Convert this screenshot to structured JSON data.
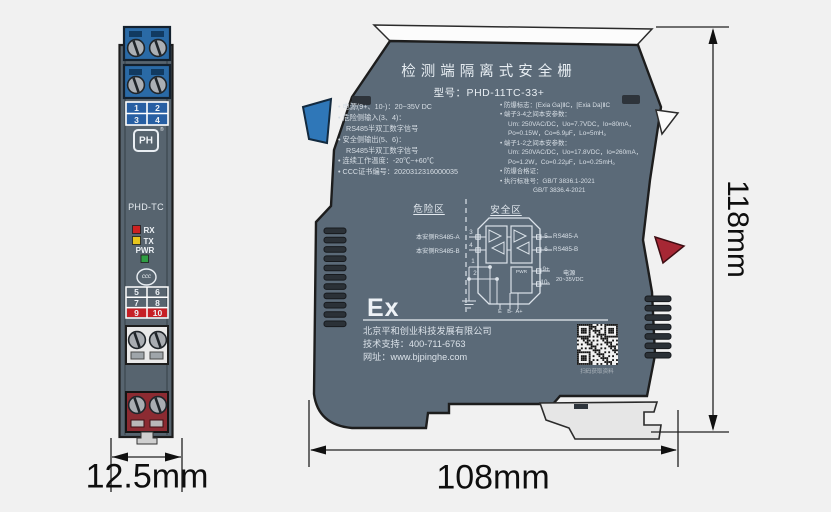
{
  "dimensions": {
    "front_width": "12.5mm",
    "side_width": "108mm",
    "side_height": "118mm"
  },
  "front_view": {
    "model": "PHD-TC",
    "logo": "PH",
    "logo_reg": "®",
    "led_rx": "RX",
    "led_tx": "TX",
    "led_pwr": "PWR",
    "cert_mark": "ccc",
    "terminals_top": [
      "1",
      "2",
      "3",
      "4"
    ],
    "terminals_bottom": [
      "5",
      "6",
      "7",
      "8",
      "9",
      "10"
    ]
  },
  "side_view": {
    "title": "检测端隔离式安全栅",
    "model": "型号：PHD-11TC-33+",
    "specs_left": [
      "• 电源(9+、10-)：20~35V DC",
      "• 危险侧输入(3、4)：",
      "RS485半双工数字信号",
      "• 安全侧输出(5、6)：",
      "RS485半双工数字信号",
      "• 连续工作温度：-20℃~+60℃",
      "• CCC证书编号：2020312316000035"
    ],
    "specs_right": [
      "• 防爆标志：[Exia Ga]ⅡC，[Exia Da]ⅡC",
      "• 端子3-4之间本安参数：",
      "Um: 250VAC/DC，Uo=7.7VDC，Io=80mA，",
      "Po=0.15W，Co=6.9μF，Lo=5mH。",
      "• 端子1-2之间本安参数：",
      "Um: 250VAC/DC，Uo=17.8VDC，Io=260mA，",
      "Po=1.2W，Co=0.22μF，Lo=0.25mH。",
      "• 防爆合格证：",
      "• 执行标准号：GB/T 3836.1-2021",
      "GB/T 3836.4-2021"
    ],
    "circuit": {
      "zone_hazard": "危险区",
      "zone_safe": "安全区",
      "input_a": "本安侧RS485-A",
      "input_b": "本安侧RS485-B",
      "t3": "3",
      "t4": "4",
      "t1": "1",
      "t2": "2",
      "t5": "5",
      "t6": "6",
      "t9": "9+",
      "t10": "10-",
      "out_a": "RS485-A",
      "out_b": "RS485-B",
      "pwr": "PWR",
      "power": "电源",
      "power_range": "20~35VDC",
      "e": "E",
      "bm": "B-",
      "ap": "A+"
    },
    "ex_mark": "Ex",
    "company": "北京平和创业科技发展有限公司",
    "support": "技术支持：400-711-6763",
    "website": "网址：www.bjpinghe.com",
    "qr_caption": "扫码获取资料"
  },
  "colors": {
    "background": "#f1f1f1",
    "device_body": "#5b6a78",
    "terminal_blue": "#2a6aa6",
    "terminal_red": "#8c2b32",
    "cell_red": "#c62026",
    "led_rx": "#cd2121",
    "led_tx": "#e7c51c",
    "led_pwr": "#2f9e44",
    "label_text": "#dce3ea"
  }
}
